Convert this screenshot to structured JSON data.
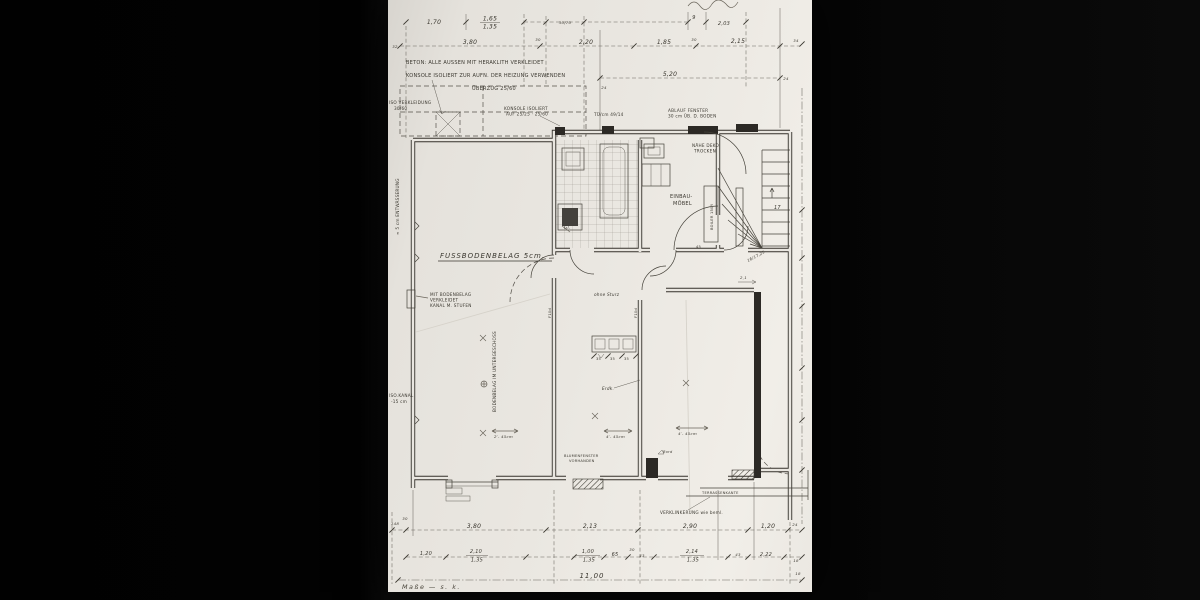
{
  "colors": {
    "paper": "#eae7e1",
    "ink": "#3a372f",
    "pencil": "#6b665c",
    "background": "#050505"
  },
  "notes": {
    "beton": "BETON: ALLE AUSSEN MIT HERAKLITH VERKLEIDET",
    "konsole": "KONSOLE ISOLIERT ZUR AUFN. DER HEIZUNG VERWENDEN",
    "ueberzug": "ÜBERZUG 25/60",
    "iso1": "ISO VERKLEIDUNG",
    "iso2": "30/60",
    "entw": "≈ 5 cm ENTWÄSSERUNG",
    "kbox1": "KONSOLE ISOLIERT",
    "kbox2": "AUF 25/25 · 25/60",
    "tu": "TÜ/cm 49/14",
    "abl1": "ABLAUF FENSTER",
    "abl2": "30 cm ÜB. D. BODEN",
    "nae1": "NÄHE DEKO",
    "nae2": "TROCKEN",
    "einb1": "EINBAU-",
    "einb2": "MÖBEL",
    "boiler": "BOILER 150/l",
    "fuss": "FUSSBODENBELAG 5cm.",
    "ohne": "ohne Sturz",
    "mb1": "MIT BODENBELAG",
    "mb2": "VERKLEIDET",
    "mb3": "KANAL M. STUFEN",
    "bodv": "BODENBELAG IM UNTERGESCHOSS",
    "isok1": "ISO.KANAL",
    "isok2": "-15 cm",
    "erdk": "Erdk.",
    "gl": "Gl.",
    "bord": "Bord",
    "blu1": "BLUMENFENSTER",
    "blu2": "VORHANDEN",
    "verk": "VERKLINKERUNG wie beml.",
    "terr": "TERRASSENKANTE",
    "mass": "Maße — s. k.",
    "f10a": "F10d",
    "f10b": "F10d",
    "steps": "17",
    "stairdim": "16/17,25",
    "stairarrow": "2,1",
    "d45a": "2′- 45cm",
    "d45b": "4′- 45cm",
    "d45c": "4′- 45cm",
    "t35a": "35",
    "t35b": "35",
    "t35c": "35",
    "d45": "45"
  },
  "dims": {
    "top1": {
      "a": "1,70",
      "b": "1,65",
      "c": "1,35",
      "d": "30/70",
      "e": "9",
      "f": "2,03"
    },
    "top2": {
      "a": "32",
      "b": "3,80",
      "c": "2,20",
      "d": "1,85",
      "e": "2,15",
      "f": "34",
      "s1": "30",
      "s2": "30"
    },
    "top3": {
      "a": "5,20",
      "b": "24",
      "c": "24"
    },
    "bot1": {
      "a": "148",
      "s": "30",
      "b": "3,80",
      "c": "2,13",
      "d": "2,90",
      "e": "1,20",
      "f": "24"
    },
    "bot2": {
      "a": "1,20",
      "b": "2,10",
      "b2": "1,35",
      "c": "1,00",
      "c2": "1,35",
      "d": "65",
      "s": "30",
      "e": "43",
      "f": "2,14",
      "f2": "1,35",
      "g": "43",
      "h": "2,22",
      "i": "18"
    },
    "total": {
      "a": "11,00",
      "r": "18"
    }
  }
}
